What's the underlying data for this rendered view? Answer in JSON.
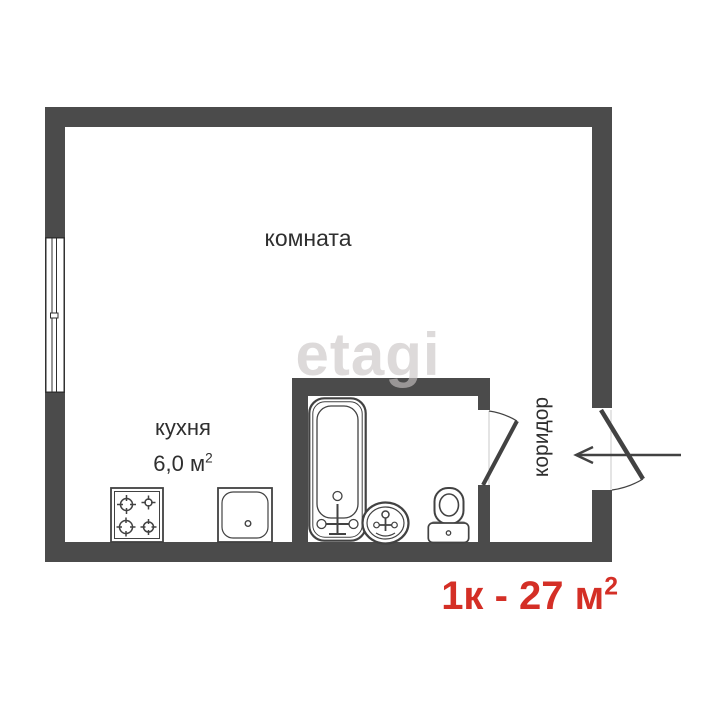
{
  "palette": {
    "wall": "#4b4b4b",
    "line": "#424242",
    "text": "#2f2f2f",
    "accent_red": "#d42f26",
    "watermark": "#c9c5c5",
    "faint": "#c9c9c9",
    "background": "#ffffff"
  },
  "floorplan": {
    "living_room": {
      "label": "комната"
    },
    "kitchen": {
      "label": "кухня",
      "area_value": "6,0 м",
      "area_sup": "2"
    },
    "corridor": {
      "label": "коридор"
    },
    "fixtures": {
      "stove": "stove-icon",
      "kitchen_sink": "kitchen-sink-icon",
      "bathtub": "bathtub-icon",
      "washbasin": "washbasin-icon",
      "toilet": "toilet-icon",
      "window": "window",
      "bathroom_door": "bathroom-door-icon",
      "entrance_door": "entrance-door-icon",
      "entrance_arrow": "entrance-arrow-icon"
    }
  },
  "watermark": {
    "text": "etagi"
  },
  "caption": {
    "value": "1к - 27 м",
    "sup": "2"
  }
}
